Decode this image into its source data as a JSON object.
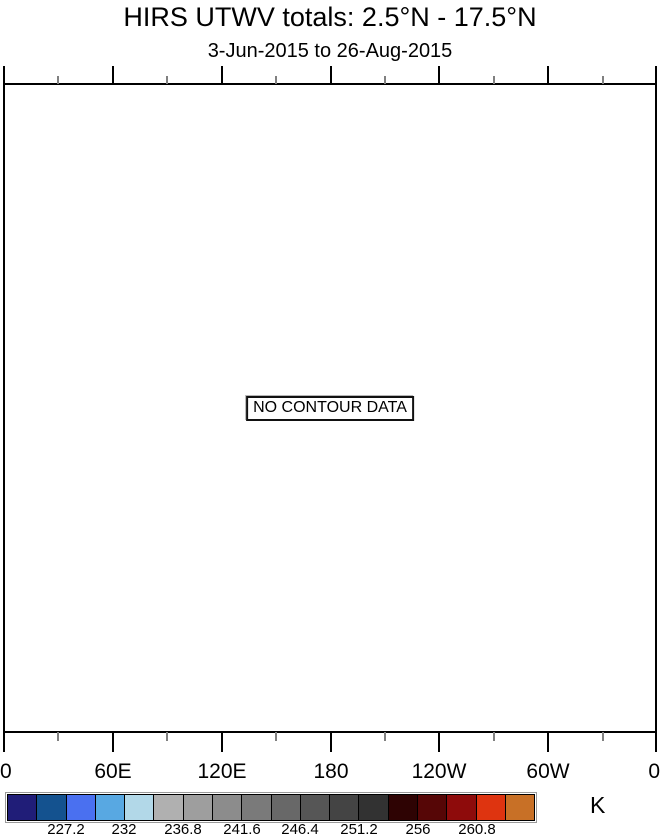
{
  "title": "HIRS UTWV totals: 2.5°N - 17.5°N",
  "subtitle": "3-Jun-2015 to 26-Aug-2015",
  "plot": {
    "no_data_label": "NO CONTOUR DATA"
  },
  "x_axis": {
    "tick_labels": [
      "0",
      "60E",
      "120E",
      "180",
      "120W",
      "60W",
      "0"
    ]
  },
  "colorbar": {
    "unit_label": "K",
    "tick_labels": [
      "227.2",
      "232",
      "236.8",
      "241.6",
      "246.4",
      "251.2",
      "256",
      "260.8"
    ],
    "segment_colors": [
      "#201d78",
      "#14528f",
      "#4a70f0",
      "#58a8e2",
      "#b2d8e8",
      "#b0b0b0",
      "#9e9e9e",
      "#8c8c8c",
      "#7a7a7a",
      "#686868",
      "#565656",
      "#444444",
      "#323232",
      "#2e0303",
      "#560606",
      "#8e0b0b",
      "#de3410",
      "#c87026"
    ]
  },
  "chart_data": {
    "type": "heatmap",
    "title": "HIRS UTWV totals: 2.5°N - 17.5°N",
    "subtitle": "3-Jun-2015 to 26-Aug-2015",
    "annotation": "NO CONTOUR DATA",
    "x_tick_labels": [
      "0",
      "60E",
      "120E",
      "180",
      "120W",
      "60W",
      "0"
    ],
    "x_range_degrees": [
      0,
      360
    ],
    "x_minor_tick_interval_degrees": 30,
    "series": [],
    "values": [],
    "colorbar_unit": "K",
    "colorbar_levels_K": [
      222.4,
      224.8,
      227.2,
      229.6,
      232,
      234.4,
      236.8,
      239.2,
      241.6,
      244,
      246.4,
      248.8,
      251.2,
      253.6,
      256,
      258.4,
      260.8,
      263.2,
      265.6
    ],
    "colorbar_labeled_levels_K": [
      227.2,
      232,
      236.8,
      241.6,
      246.4,
      251.2,
      256,
      260.8
    ],
    "legend_position": "bottom",
    "grid": false
  }
}
